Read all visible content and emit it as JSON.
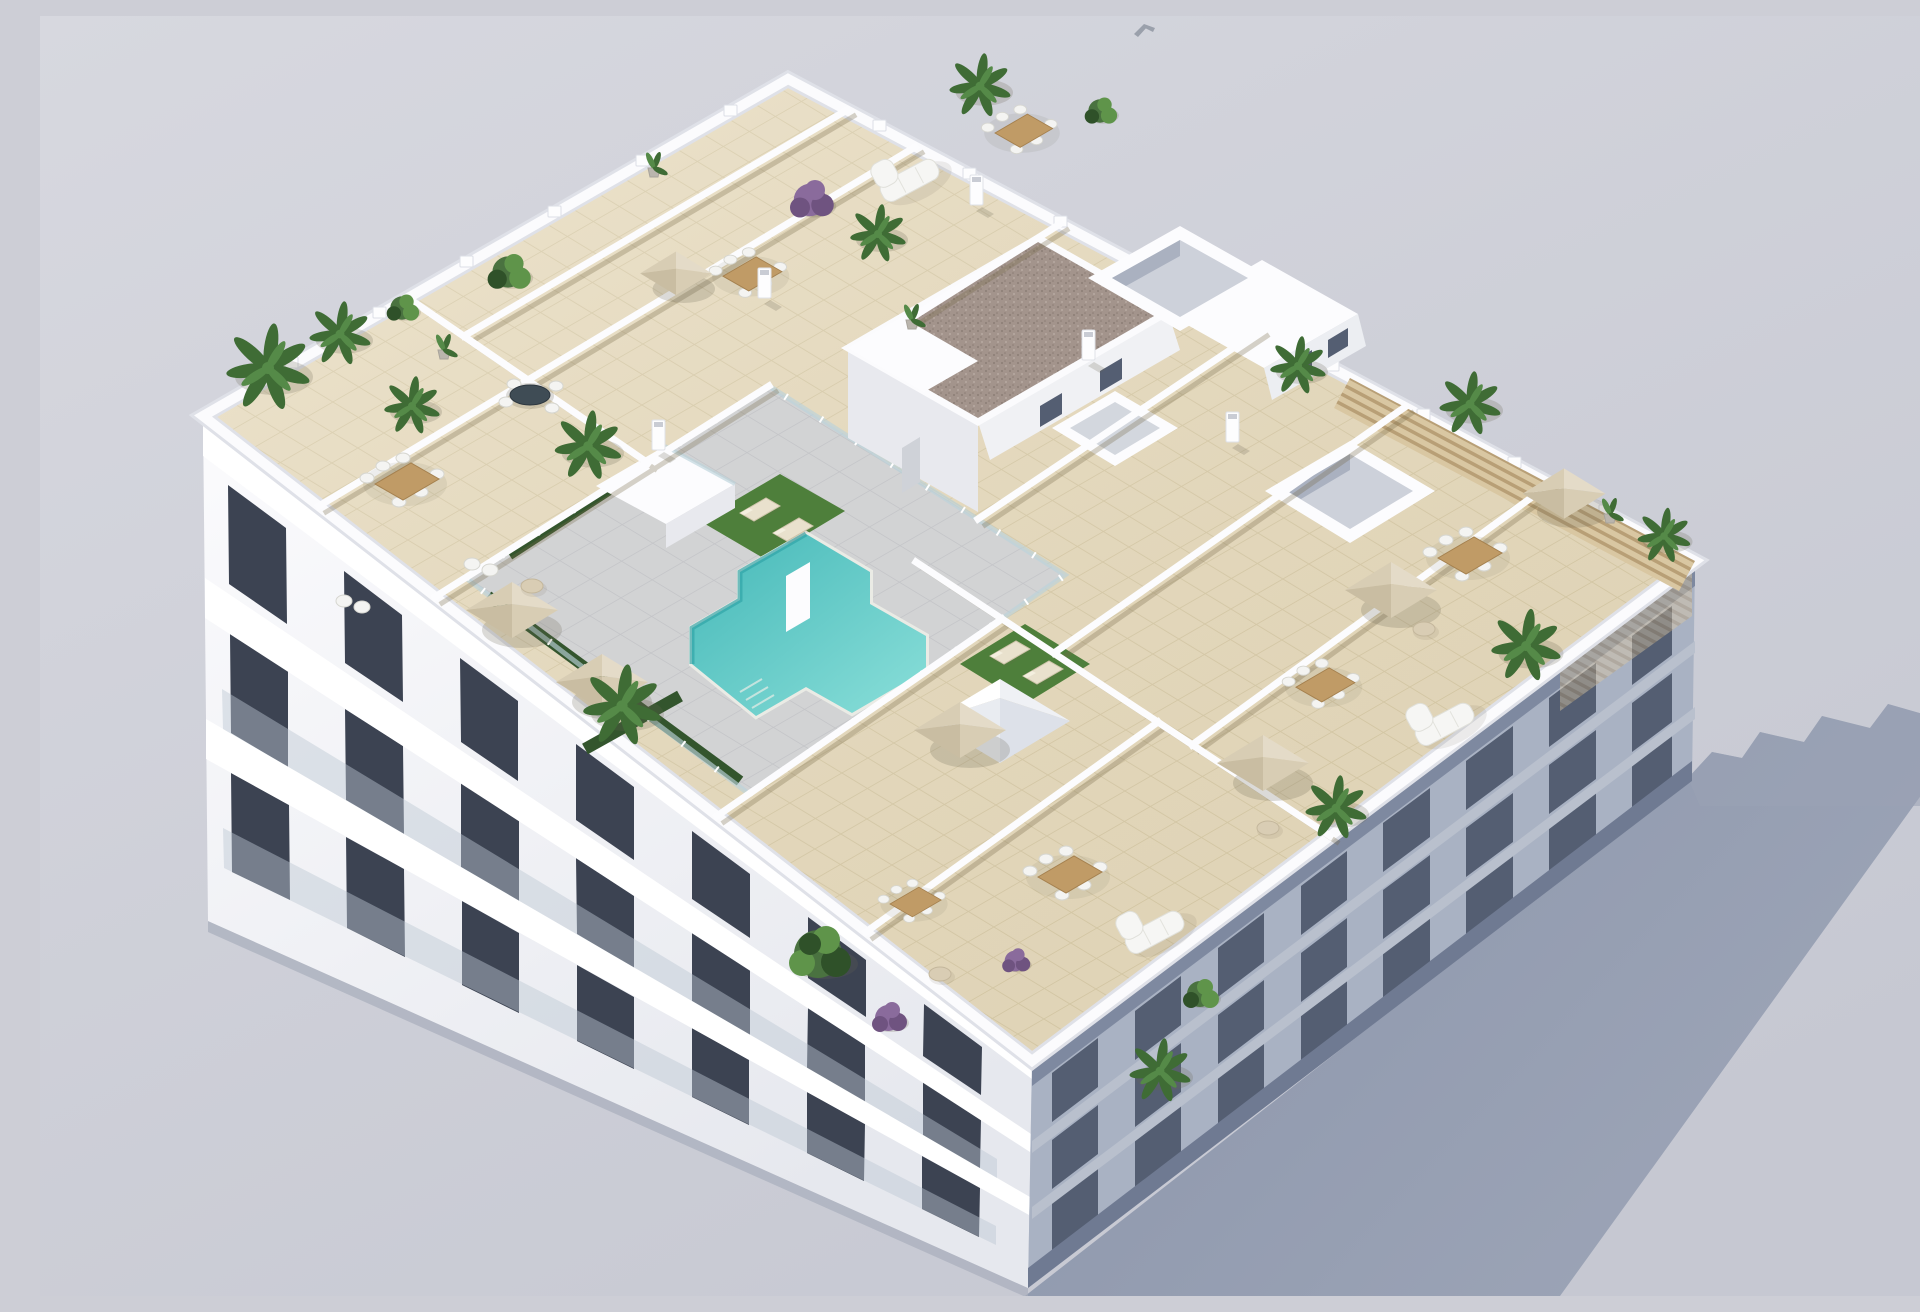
{
  "meta": {
    "title": "Aerial 3D render — rooftop pool terrace of a white apartment building",
    "description": "Bird's-eye isometric architectural visualization: white residential block with cream-tiled private roof terraces, beige parasols, timber dining sets, white sofas, potted palms and purple shrubs, a glass-fenced communal pool deck with turquoise pool, lawn and sun loungers, a gravel-roofed stair core, skylight boxes, a timber pergola at the east corner, sunlit balcony facade at lower left and a long blue-grey shadow cast on plain grey ground."
  },
  "scene": {
    "objects": [
      {
        "name": "rooftop",
        "label": "Tiled rooftop with private terraces"
      },
      {
        "name": "pool",
        "label": "Communal T-shaped swimming pool with glass fence"
      },
      {
        "name": "lawns",
        "label": "Two artificial lawns with sun loungers"
      },
      {
        "name": "parasols",
        "label": "Seven beige square parasols",
        "count": 7
      },
      {
        "name": "dining-sets",
        "label": "Timber dining tables with white chairs",
        "count": 8
      },
      {
        "name": "stair-core",
        "label": "Stair/lift core with brown gravel roof"
      },
      {
        "name": "skylights",
        "label": "White skylight boxes and pyramid rooflight"
      },
      {
        "name": "pergola",
        "label": "Timber slat pergola at east corner"
      },
      {
        "name": "facade-sunlit",
        "label": "White facade with three balcony floors"
      },
      {
        "name": "facade-shaded",
        "label": "Shaded south-east facade"
      },
      {
        "name": "cast-shadow",
        "label": "Long cast shadow on ground"
      },
      {
        "name": "bird",
        "label": "Small grey bird in sky"
      }
    ]
  },
  "colors": {
    "bg_top": "#d7d8df",
    "bg_bottom": "#c6c8d2",
    "shadow_near": "#8a94aa",
    "shadow_far": "#9da5b7",
    "soft_shadow": "rgba(105,100,80,0.22)",
    "facade_sun_hi": "#fbfbfd",
    "facade_sun_lo": "#e6e8ee",
    "facade_shade": "#a9b2c3",
    "facade_shade_band": "#b9c0cd",
    "facade_shade_top": "#7e89a0",
    "facade_shade_base": "#6f7a92",
    "window_dark": "#3c4352",
    "window_shade": "#545e72",
    "slab": "#ffffff",
    "roof_tile": "#e9ddc0",
    "roof_grout": "#d9cca9",
    "parapet": "#fbfbfd",
    "parapet_outer": "#dfe1e8",
    "wall": "#fcfcfe",
    "wall_side": "#e8e9ee",
    "wall_shadow": "rgba(120,106,72,0.30)",
    "deck": "#d2d3d4",
    "deck_line": "#c4c5c8",
    "pool_deep": "#45b8b8",
    "pool_light": "#8adfd9",
    "pool_coping": "#eaebe5",
    "pool_shade": "#2ea3a6",
    "lawn": "#4e7f3b",
    "hedge": "#33552d",
    "glass": "rgba(188,211,218,0.65)",
    "wood": "#c09b66",
    "wood_dark": "#a5814f",
    "umbrella": "#e4dbc8",
    "umbrella_mid": "#d8cdb4",
    "umbrella_dark": "#c9bda2",
    "sofa": "#f6f6f4",
    "chair": "#f4f4f2",
    "lounger": "#e9e1cd",
    "gravel": "#a3948c",
    "gravel_dot1": "#8b7d75",
    "gravel_dot2": "#b7aaa1",
    "pergola_light": "#d9c7a2",
    "pergola_dark": "#b89f76",
    "palm": "#3f6c35",
    "palm_light": "#558a48",
    "bush": "#4a7240",
    "bush_light": "#5f944a",
    "bush_dark": "#2f5129",
    "purple": "#8a6b9c",
    "purple_dark": "#6f5380",
    "pot": "#bab5ad",
    "bird": "#9aa0ab"
  }
}
